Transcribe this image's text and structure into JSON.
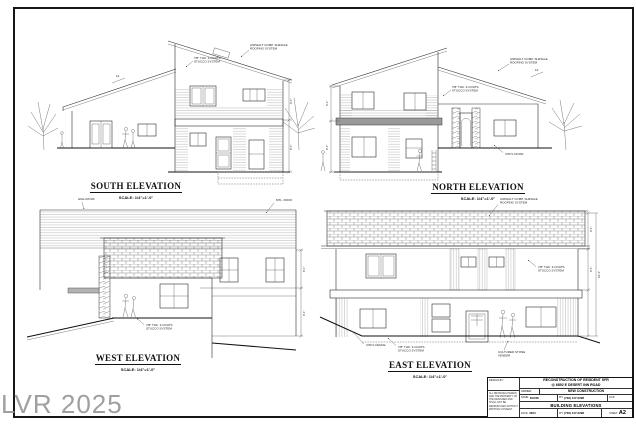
{
  "sheet": {
    "watermark": "LVR 2025",
    "elevations": [
      {
        "title": "SOUTH ELEVATION",
        "scale": "SCALE: 1/4\"=1'-0\""
      },
      {
        "title": "NORTH ELEVATION",
        "scale": "SCALE: 1/4\"=1'-0\""
      },
      {
        "title": "WEST ELEVATION",
        "scale": "SCALE: 1/4\"=1'-0\""
      },
      {
        "title": "EAST ELEVATION",
        "scale": "SCALE: 1/4\"=1'-0\""
      }
    ],
    "annotations": {
      "roof_1": "ASPHALT COMP. SHINGLE",
      "roof_2": "ROOFING SYSTEM",
      "stucco_1": "7/8\" THK. 3-COATS",
      "stucco_2": "STUCCO SYSTEM",
      "high_roof": "HIGH ROOF",
      "mtl_roof": "MTL. ROOF",
      "vinyl_door": "VINYL DOOR",
      "vinyl_fence": "VINYL FENCE",
      "stone_1": "CULTURED STONE",
      "stone_2": "VENEER",
      "slope": "12",
      "dim_9": "9'-1\"",
      "dim_8": "8'-1\"",
      "dim_18": "18'-2\""
    },
    "title_block": {
      "firm_label": "DESIGN BY:",
      "firm_note": "ALL DRAWINGS HEREIN ARE THE PROPERTY OF THE DESIGNER AND SHALL NOT BE REPRODUCED WITHOUT WRITTEN CONSENT.",
      "project_line1": "RECONSTRUCTION OF RESIDENT SFR",
      "project_line2": "@ 6892 E DESERT INN ROAD",
      "owner_label": "OWNER:",
      "owner_value": "NEW CONSTRUCTION",
      "name_label": "NAME:",
      "name_value": "DAVID",
      "phone_label": "PH:",
      "phone_value": "(702) 417-0298",
      "lic_label": "LIC#:",
      "sheet_title": "BUILDING ELEVATIONS",
      "date_label": "DATE:",
      "date_value": "2024",
      "sheet_no_label": "SHEET:",
      "sheet_no": "A2"
    }
  }
}
